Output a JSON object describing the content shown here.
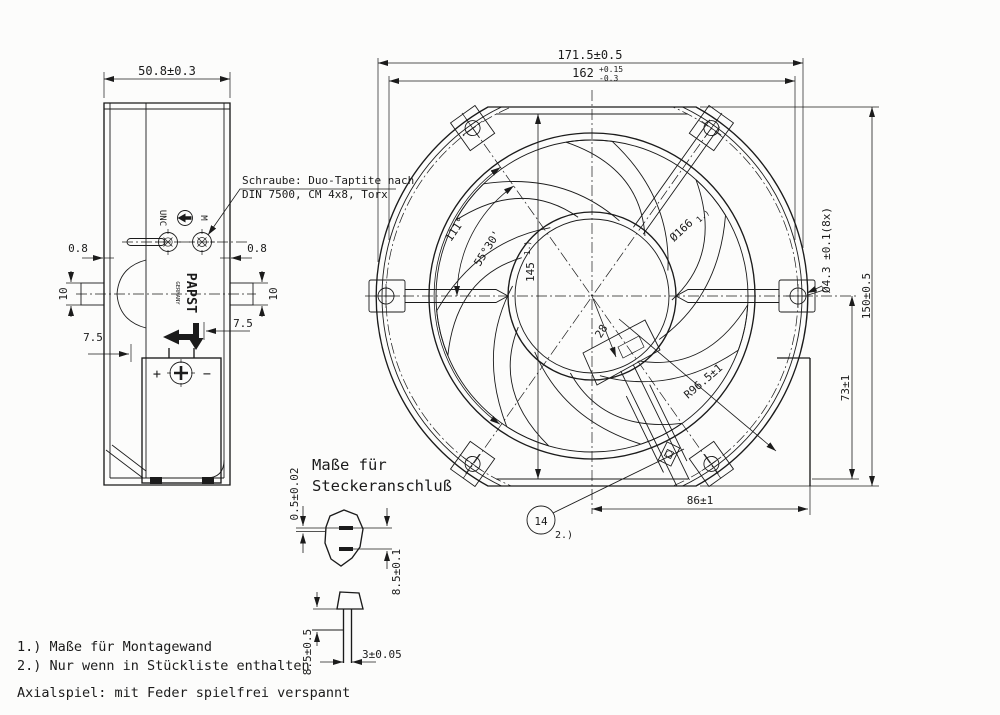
{
  "side_view": {
    "width_dim": "50.8±0.3",
    "screw_note_line1": "Schraube: Duo-Taptite nach",
    "screw_note_line2": "DIN 7500, CM 4x8, Torx",
    "dim_08_left": "0.8",
    "dim_08_right": "0.8",
    "dim_10_left": "10",
    "dim_10_right": "10",
    "dim_75_left": "7.5",
    "dim_75_right": "7.5",
    "thread_unc": "UNC",
    "thread_m": "M",
    "brand": "PAPST",
    "brand_country": "GERMANY",
    "terminal_plus": "+",
    "terminal_minus": "−"
  },
  "front_view": {
    "dim_outer_width": "171.5±0.5",
    "dim_mount": "162",
    "dim_mount_tol_plus": "+0.15",
    "dim_mount_tol_minus": "-0.3",
    "dim_height": "150±0.5",
    "dim_73": "73±1",
    "dim_holes": "Ø4.3 ±0.1(8x)",
    "dim_86": "86±1",
    "dim_145": "145",
    "dim_145_ref": "1.)",
    "dim_d166": "Ø166",
    "dim_d166_ref": "1.)",
    "dim_r965": "R96.5±1",
    "dim_28": "28",
    "angle_111": "111°",
    "angle_5530": "55°30'",
    "balloon_number": "14",
    "balloon_ref": "2.)"
  },
  "connector_detail": {
    "title_line1": "Maße für",
    "title_line2": "Steckeranschluß",
    "dim_05": "0.5±0.02",
    "dim_85_pins": "8.5±0.1",
    "dim_85_side": "8.5±0.5",
    "dim_3": "3±0.05"
  },
  "notes": {
    "note1": "1.) Maße für Montagewand",
    "note2": "2.) Nur wenn in Stückliste enthalten",
    "axial": "Axialspiel: mit Feder spielfrei verspannt"
  }
}
